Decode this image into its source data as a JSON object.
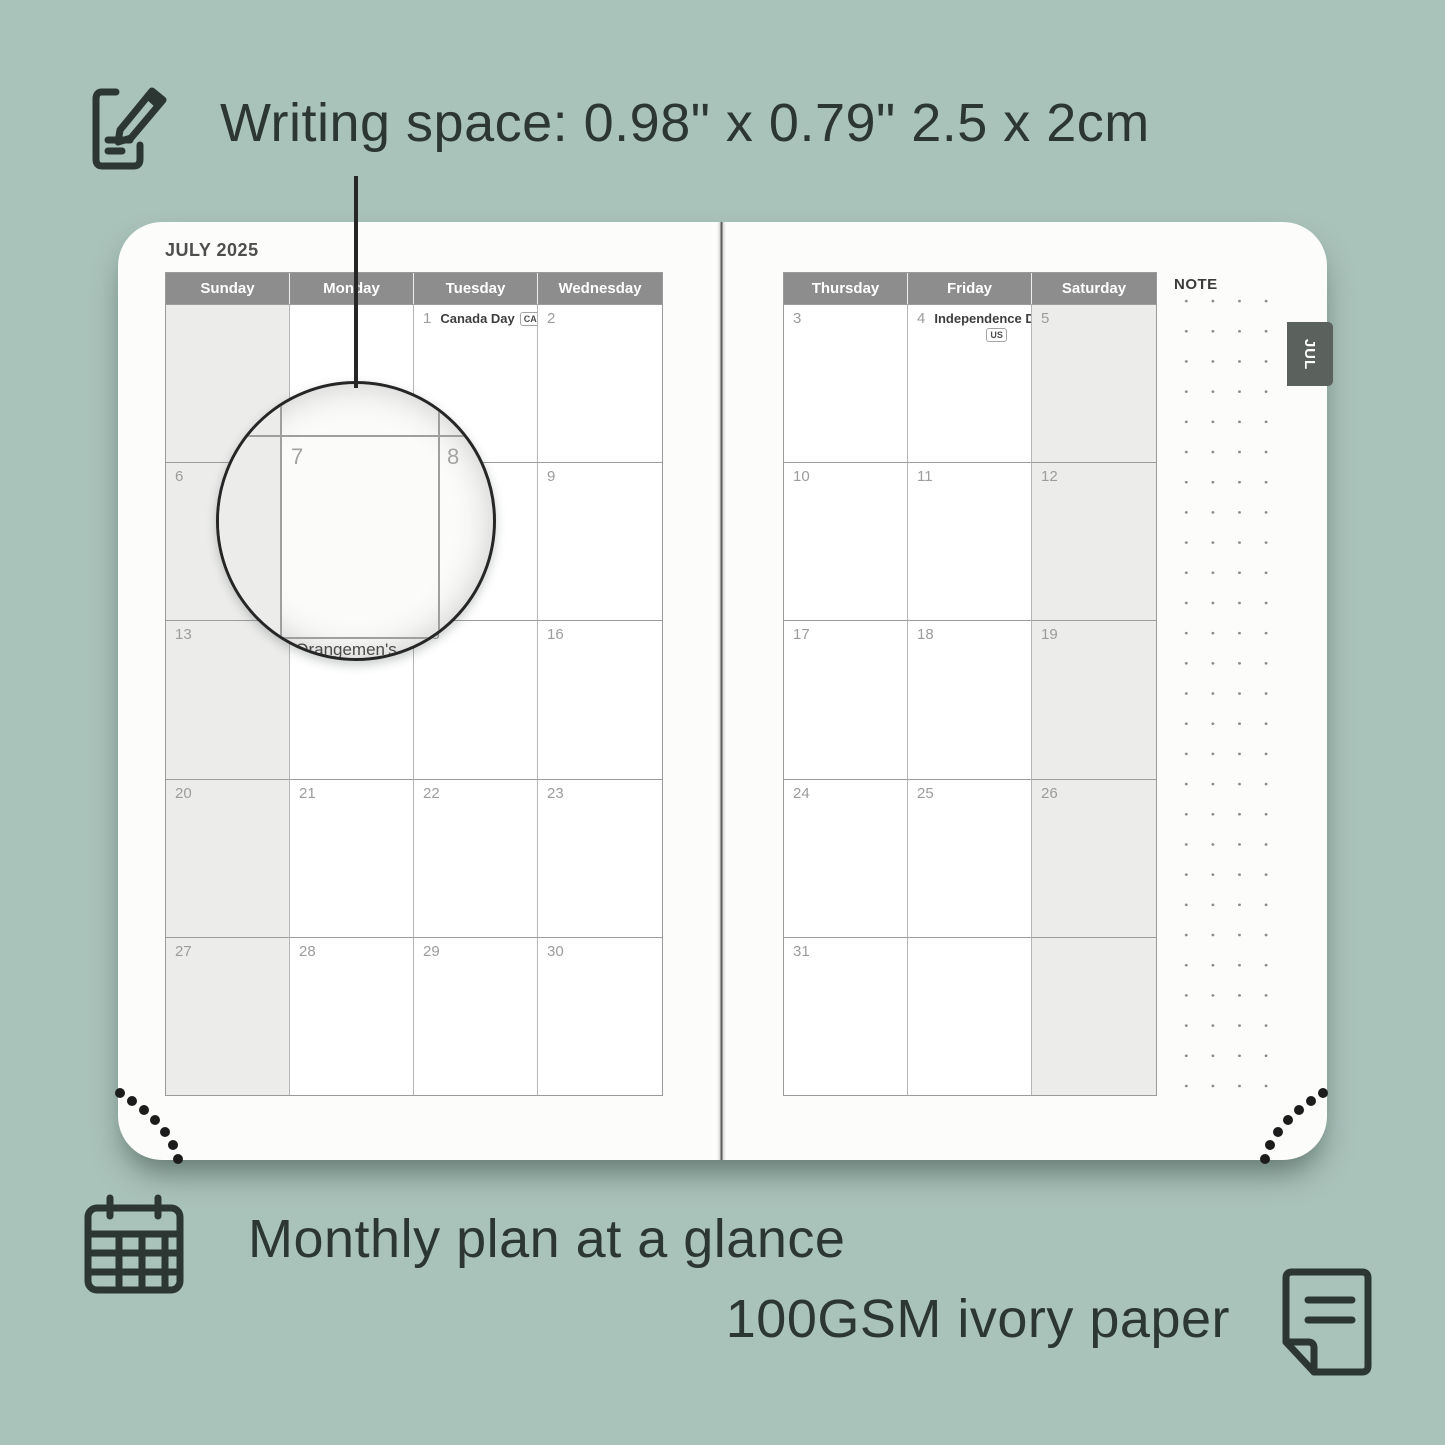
{
  "annotations": {
    "writing_space": "Writing space: 0.98\" x 0.79\" 2.5 x 2cm",
    "monthly_plan": "Monthly plan at a glance",
    "paper": "100GSM ivory paper"
  },
  "icons": {
    "top": "pencil-note-icon",
    "bottom_left": "calendar-grid-icon",
    "bottom_right": "paper-sheet-icon"
  },
  "colors": {
    "background": "#a9c2ba",
    "text_dark": "#2c3733",
    "page": "#fcfcfa",
    "header_gray": "#8d8d8d",
    "shaded_cell": "#ececeb",
    "tab_gray": "#5b615d"
  },
  "planner": {
    "title": "JULY 2025",
    "tab": "JUL",
    "note_label": "NOTE",
    "left_page": {
      "day_headers": [
        "Sunday",
        "Monday",
        "Tuesday",
        "Wednesday"
      ],
      "rows": [
        {
          "cells": [
            {
              "day": ""
            },
            {
              "day": ""
            },
            {
              "day": "1",
              "holiday": "Canada Day",
              "badge": "CA"
            },
            {
              "day": "2"
            }
          ]
        },
        {
          "cells": [
            {
              "day": "6"
            },
            {
              "day": "7"
            },
            {
              "day": "8"
            },
            {
              "day": "9"
            }
          ]
        },
        {
          "cells": [
            {
              "day": "13"
            },
            {
              "day": "14"
            },
            {
              "day": "15"
            },
            {
              "day": "16"
            }
          ]
        },
        {
          "cells": [
            {
              "day": "20"
            },
            {
              "day": "21"
            },
            {
              "day": "22"
            },
            {
              "day": "23"
            }
          ]
        },
        {
          "cells": [
            {
              "day": "27"
            },
            {
              "day": "28"
            },
            {
              "day": "29"
            },
            {
              "day": "30"
            }
          ]
        }
      ]
    },
    "right_page": {
      "day_headers": [
        "Thursday",
        "Friday",
        "Saturday"
      ],
      "rows": [
        {
          "cells": [
            {
              "day": "3"
            },
            {
              "day": "4",
              "holiday": "Independence Day",
              "badge": "US"
            },
            {
              "day": "5"
            }
          ]
        },
        {
          "cells": [
            {
              "day": "10"
            },
            {
              "day": "11"
            },
            {
              "day": "12"
            }
          ]
        },
        {
          "cells": [
            {
              "day": "17"
            },
            {
              "day": "18"
            },
            {
              "day": "19"
            }
          ]
        },
        {
          "cells": [
            {
              "day": "24"
            },
            {
              "day": "25"
            },
            {
              "day": "26"
            }
          ]
        },
        {
          "cells": [
            {
              "day": "31"
            },
            {
              "day": ""
            },
            {
              "day": ""
            }
          ]
        }
      ]
    },
    "magnifier": {
      "day_left": "7",
      "day_right": "8",
      "bottom_text": "Orangemen's"
    }
  }
}
